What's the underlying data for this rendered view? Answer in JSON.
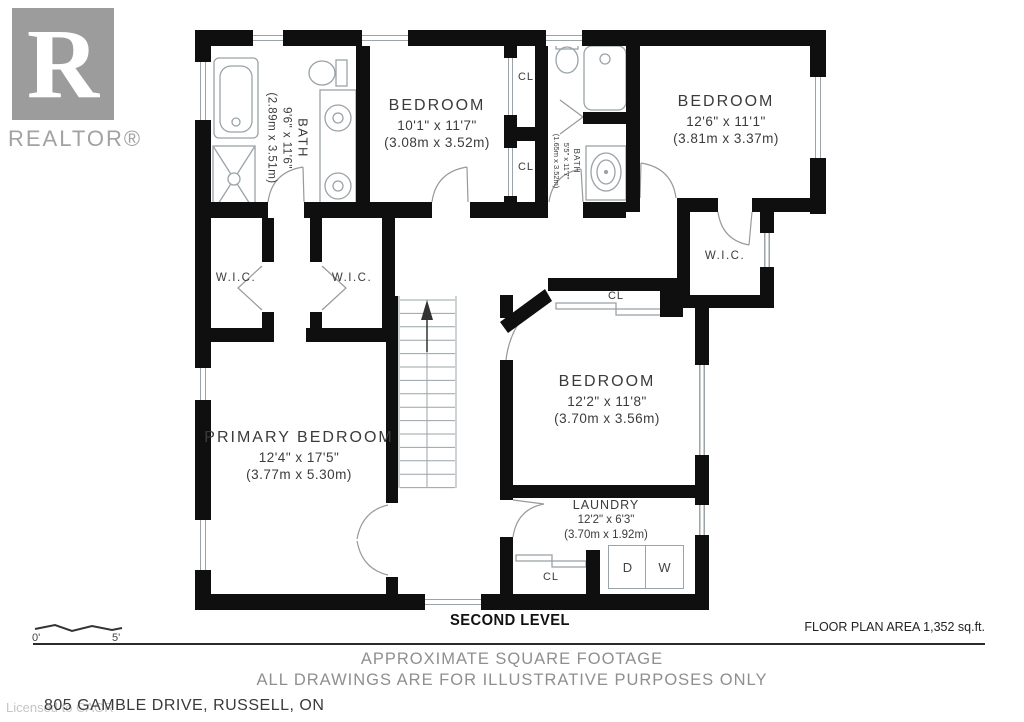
{
  "branding": {
    "logo_letter": "R",
    "logo_word": "REALTOR®"
  },
  "watermark": "Licensed to CAOR",
  "plan": {
    "rooms": {
      "ensuite_bath": {
        "name": "BATH",
        "imperial": "9'6\" x 11'6\"",
        "metric": "(2.89m x 3.51m)"
      },
      "bedroom_top": {
        "name": "BEDROOM",
        "imperial": "10'1\" x 11'7\"",
        "metric": "(3.08m x 3.52m)"
      },
      "hall_bath": {
        "name": "BATH",
        "imperial": "5'5\" x 11'7\"",
        "metric": "(1.65m x 3.52m)"
      },
      "bedroom_right": {
        "name": "BEDROOM",
        "imperial": "12'6\" x 11'1\"",
        "metric": "(3.81m x 3.37m)"
      },
      "bedroom_mid": {
        "name": "BEDROOM",
        "imperial": "12'2\" x 11'8\"",
        "metric": "(3.70m x 3.56m)"
      },
      "primary": {
        "name": "PRIMARY BEDROOM",
        "imperial": "12'4\" x 17'5\"",
        "metric": "(3.77m x 5.30m)"
      },
      "laundry": {
        "name": "LAUNDRY",
        "imperial": "12'2\" x 6'3\"",
        "metric": "(3.70m x 1.92m)"
      }
    },
    "labels": {
      "wic": "W.I.C.",
      "closet": "CL",
      "dryer": "D",
      "washer": "W"
    }
  },
  "footer": {
    "level": "SECOND LEVEL",
    "area": "FLOOR PLAN AREA 1,352 sq.ft.",
    "note1": "APPROXIMATE SQUARE FOOTAGE",
    "note2": "ALL DRAWINGS ARE FOR ILLUSTRATIVE PURPOSES ONLY",
    "address": "805 GAMBLE DRIVE, RUSSELL, ON"
  },
  "scale": {
    "start": "0'",
    "end": "5'"
  },
  "colors": {
    "wall": "#0f0f0f",
    "fixture": "#9aa3a8",
    "door": "#999999",
    "label": "#3b3b3b",
    "muted": "#8f8f8f",
    "logo": "#9c9c9c"
  }
}
